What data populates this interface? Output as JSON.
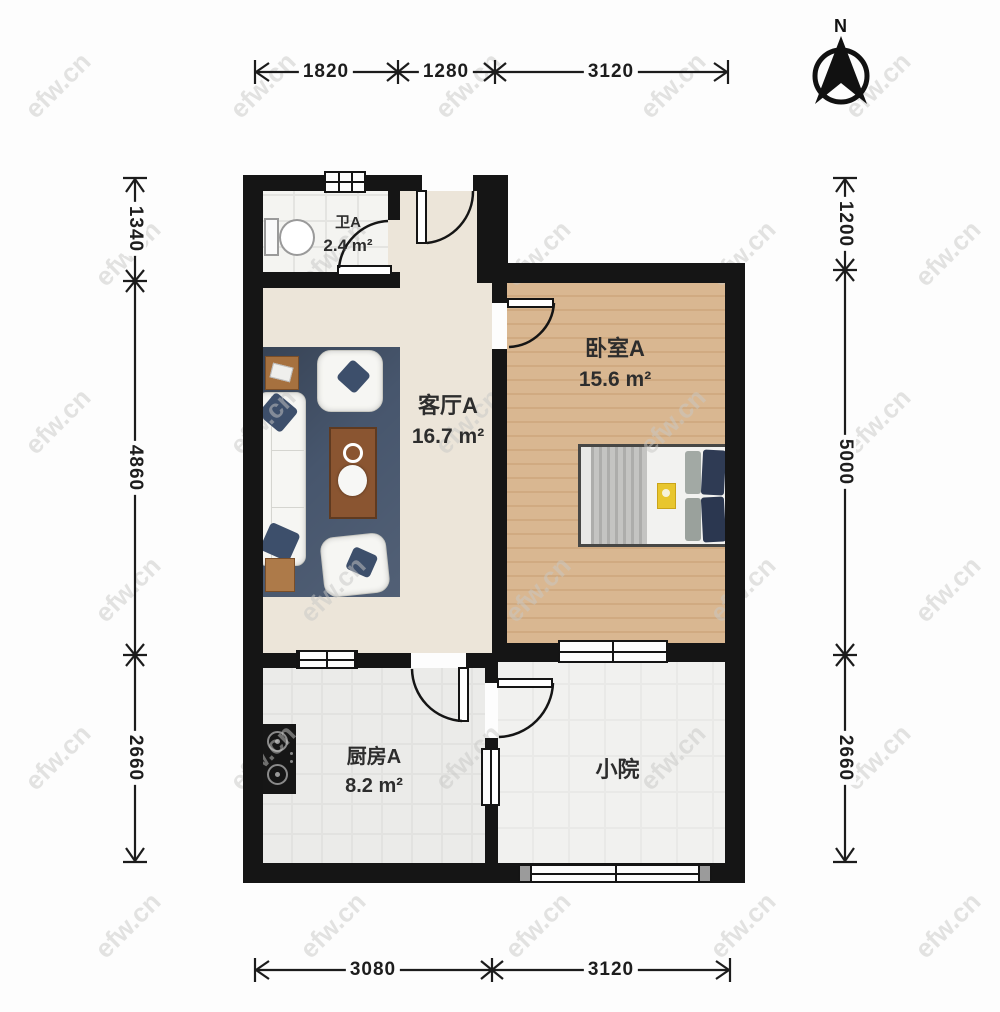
{
  "meta": {
    "north": "N",
    "watermark": "efw.cn"
  },
  "rooms": {
    "bathroom": {
      "name": "卫A",
      "area": "2.4 m²"
    },
    "living": {
      "name": "客厅A",
      "area": "16.7 m²"
    },
    "bedroom": {
      "name": "卧室A",
      "area": "15.6 m²"
    },
    "kitchen": {
      "name": "厨房A",
      "area": "8.2 m²"
    },
    "courtyard": {
      "name": "小院"
    }
  },
  "dimensions": {
    "top": [
      "1820",
      "1280",
      "3120"
    ],
    "bottom": [
      "3080",
      "3120"
    ],
    "left": [
      "1340",
      "4860",
      "2660"
    ],
    "right": [
      "1200",
      "5000",
      "2660"
    ]
  }
}
